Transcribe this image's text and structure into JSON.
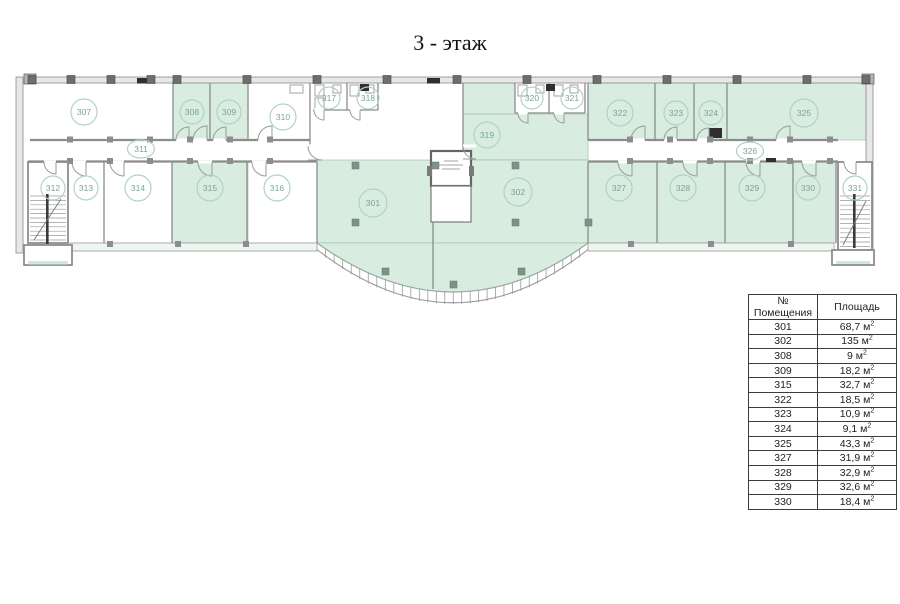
{
  "title": "3 - этаж",
  "colors": {
    "room_highlight": "#d8ecdf",
    "wall": "#8c8c8c",
    "label_stroke": "#afd4c4",
    "label_text": "#79a39c"
  },
  "plan": {
    "rooms": [
      {
        "label": "301",
        "highlighted": true
      },
      {
        "label": "302",
        "highlighted": true
      },
      {
        "label": "307",
        "highlighted": false
      },
      {
        "label": "308",
        "highlighted": true
      },
      {
        "label": "309",
        "highlighted": true
      },
      {
        "label": "310",
        "highlighted": false
      },
      {
        "label": "311",
        "highlighted": false,
        "type": "corridor"
      },
      {
        "label": "312",
        "highlighted": false,
        "type": "stairs"
      },
      {
        "label": "313",
        "highlighted": false
      },
      {
        "label": "314",
        "highlighted": false
      },
      {
        "label": "315",
        "highlighted": true
      },
      {
        "label": "316",
        "highlighted": false
      },
      {
        "label": "317",
        "highlighted": false,
        "type": "wc"
      },
      {
        "label": "318",
        "highlighted": false,
        "type": "wc"
      },
      {
        "label": "319",
        "highlighted": true
      },
      {
        "label": "320",
        "highlighted": false,
        "type": "wc"
      },
      {
        "label": "321",
        "highlighted": false,
        "type": "wc"
      },
      {
        "label": "322",
        "highlighted": true
      },
      {
        "label": "323",
        "highlighted": true
      },
      {
        "label": "324",
        "highlighted": true
      },
      {
        "label": "325",
        "highlighted": true
      },
      {
        "label": "326",
        "highlighted": false,
        "type": "corridor"
      },
      {
        "label": "327",
        "highlighted": true
      },
      {
        "label": "328",
        "highlighted": true
      },
      {
        "label": "329",
        "highlighted": true
      },
      {
        "label": "330",
        "highlighted": true
      },
      {
        "label": "331",
        "highlighted": false,
        "type": "stairs"
      }
    ]
  },
  "legend_table": {
    "headers": {
      "number": "№ Помещения",
      "area": "Площадь"
    },
    "unit_superscript": "2",
    "rows": [
      {
        "number": "301",
        "area": "68,7 м"
      },
      {
        "number": "302",
        "area": "135 м"
      },
      {
        "number": "308",
        "area": "9 м"
      },
      {
        "number": "309",
        "area": "18,2 м"
      },
      {
        "number": "315",
        "area": "32,7 м"
      },
      {
        "number": "322",
        "area": "18,5 м"
      },
      {
        "number": "323",
        "area": "10,9 м"
      },
      {
        "number": "324",
        "area": "9,1 м"
      },
      {
        "number": "325",
        "area": "43,3 м"
      },
      {
        "number": "327",
        "area": "31,9 м"
      },
      {
        "number": "328",
        "area": "32,9 м"
      },
      {
        "number": "329",
        "area": "32,6 м"
      },
      {
        "number": "330",
        "area": "18,4 м"
      }
    ]
  }
}
